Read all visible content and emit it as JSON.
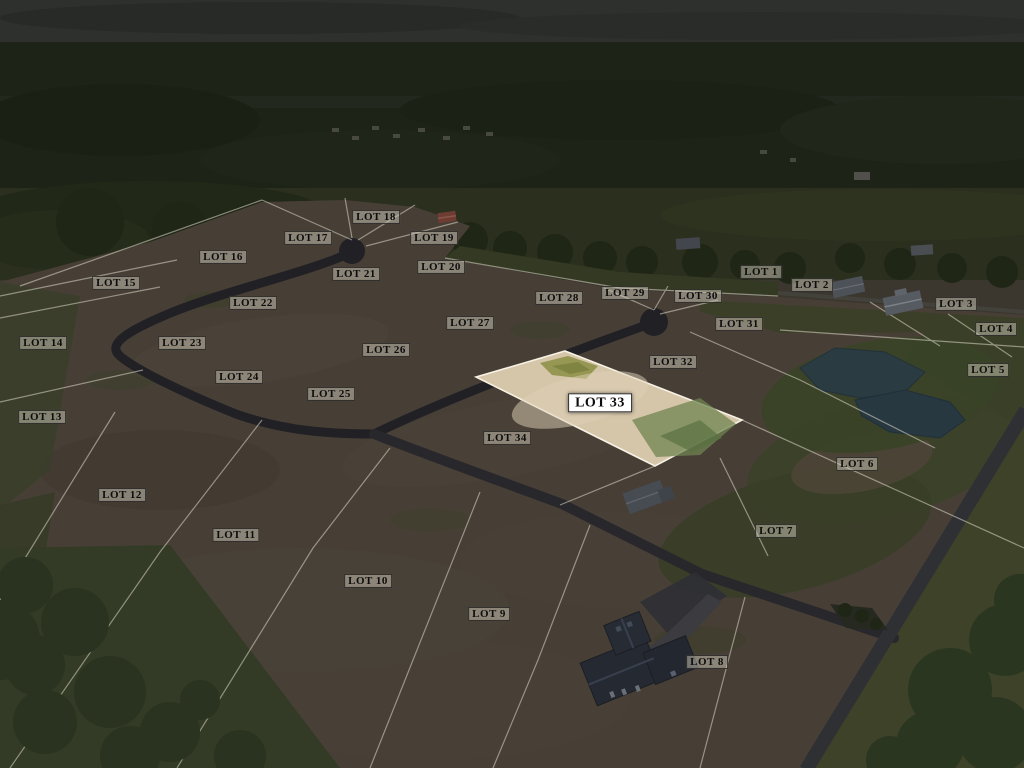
{
  "scene": {
    "kind": "darkened aerial photo of a residential lot subdivision with one highlighted lot",
    "highlighted_lot": "LOT 33"
  },
  "colors": {
    "dirt": "#473f36",
    "dark_dirt": "#3e372f",
    "grass": "#363c26",
    "forest": "#1d2317",
    "sky": "#2d302c",
    "road_new": "#212125",
    "road_main": "#2f3034",
    "pond": "#2a3b42",
    "lot_line": "#ddd8c9",
    "highlight_fill": "#d5c5a9",
    "highlight_edge": "#f7f2e4",
    "label_bg": "rgba(207,201,186,0.5)",
    "label_text": "#0d0d0d"
  },
  "highlight": {
    "lot": "LOT 33",
    "points_svg": "476,377 565,351 742,420 655,466"
  },
  "lots": {
    "labels": [
      {
        "text": "LOT 1",
        "x": 761,
        "y": 272
      },
      {
        "text": "LOT 2",
        "x": 812,
        "y": 285
      },
      {
        "text": "LOT 3",
        "x": 956,
        "y": 304
      },
      {
        "text": "LOT 4",
        "x": 996,
        "y": 329
      },
      {
        "text": "LOT 5",
        "x": 988,
        "y": 370
      },
      {
        "text": "LOT 6",
        "x": 857,
        "y": 464
      },
      {
        "text": "LOT 7",
        "x": 776,
        "y": 531
      },
      {
        "text": "LOT 8",
        "x": 707,
        "y": 662
      },
      {
        "text": "LOT 9",
        "x": 489,
        "y": 614
      },
      {
        "text": "LOT 10",
        "x": 368,
        "y": 581
      },
      {
        "text": "LOT 11",
        "x": 236,
        "y": 535
      },
      {
        "text": "LOT 12",
        "x": 122,
        "y": 495
      },
      {
        "text": "LOT 13",
        "x": 42,
        "y": 417
      },
      {
        "text": "LOT 14",
        "x": 43,
        "y": 343
      },
      {
        "text": "LOT 15",
        "x": 116,
        "y": 283
      },
      {
        "text": "LOT 16",
        "x": 223,
        "y": 257
      },
      {
        "text": "LOT 17",
        "x": 308,
        "y": 238
      },
      {
        "text": "LOT 18",
        "x": 376,
        "y": 217
      },
      {
        "text": "LOT 19",
        "x": 434,
        "y": 238
      },
      {
        "text": "LOT 20",
        "x": 441,
        "y": 267
      },
      {
        "text": "LOT 21",
        "x": 356,
        "y": 274
      },
      {
        "text": "LOT 22",
        "x": 253,
        "y": 303
      },
      {
        "text": "LOT 23",
        "x": 182,
        "y": 343
      },
      {
        "text": "LOT 24",
        "x": 239,
        "y": 377
      },
      {
        "text": "LOT 25",
        "x": 331,
        "y": 394
      },
      {
        "text": "LOT 26",
        "x": 386,
        "y": 350
      },
      {
        "text": "LOT 27",
        "x": 470,
        "y": 323
      },
      {
        "text": "LOT 28",
        "x": 559,
        "y": 298
      },
      {
        "text": "LOT 29",
        "x": 625,
        "y": 293
      },
      {
        "text": "LOT 30",
        "x": 698,
        "y": 296
      },
      {
        "text": "LOT 31",
        "x": 739,
        "y": 324
      },
      {
        "text": "LOT 32",
        "x": 673,
        "y": 362
      },
      {
        "text": "LOT 33",
        "x": 600,
        "y": 403,
        "highlight": true
      },
      {
        "text": "LOT 34",
        "x": 507,
        "y": 438
      }
    ]
  }
}
